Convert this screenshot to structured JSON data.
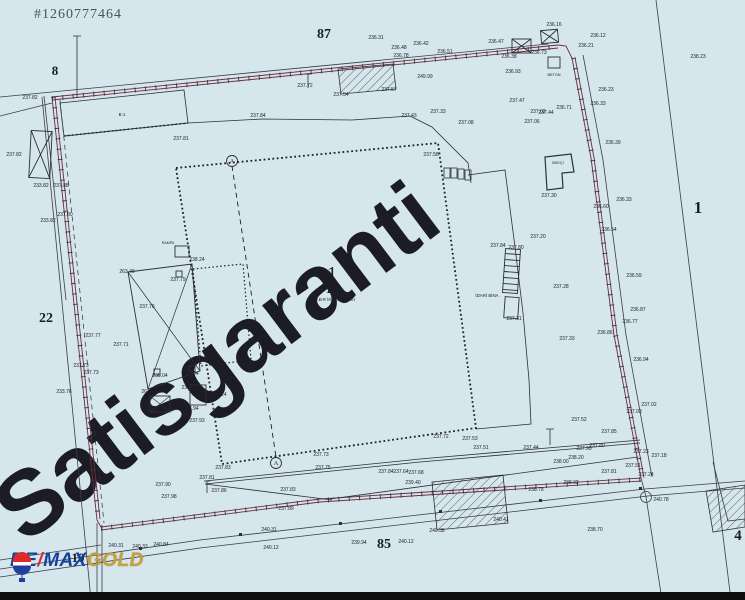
{
  "listing_id": "#1260777464",
  "watermark": "Satisgaranti",
  "colors": {
    "background": "#d5e6ec",
    "ink": "#2e2e36",
    "fence": "#6b2b3d",
    "watermark": "rgba(255,255,255,0.5)",
    "bottom_bar": "#0e0e0e"
  },
  "logo": {
    "brand_left": "RE",
    "brand_slash": "/",
    "brand_right": "MAX",
    "suffix": "GOLD",
    "brand_color": "#15439c",
    "slash_color": "#e02a2a",
    "suffix_color": "#c79f3c",
    "balloon_top": "#e02a2a",
    "balloon_bottom": "#1e3f9e"
  },
  "building": {
    "no": "1",
    "area": "141",
    "name": "FABRİKA BİNASI",
    "admin": "İDARİ BİNA",
    "guard": "BEKÇİ",
    "concrete": "BETON",
    "ramp": "RAMPA",
    "wing": "B.1"
  },
  "parcel_labels": [
    {
      "t": "8",
      "x": 55,
      "y": 75,
      "s": 13
    },
    {
      "t": "87",
      "x": 324,
      "y": 38,
      "s": 14
    },
    {
      "t": "22",
      "x": 46,
      "y": 322,
      "s": 14
    },
    {
      "t": "1",
      "x": 698,
      "y": 213,
      "s": 17
    },
    {
      "t": "85",
      "x": 384,
      "y": 548,
      "s": 14
    },
    {
      "t": "10",
      "x": 78,
      "y": 562,
      "s": 13
    },
    {
      "t": "4",
      "x": 738,
      "y": 540,
      "s": 15
    }
  ],
  "point_markers": [
    {
      "t": "A",
      "x": 232,
      "y": 161
    },
    {
      "t": "A",
      "x": 276,
      "y": 463
    }
  ],
  "elevations": [
    [
      30,
      99,
      "237.82"
    ],
    [
      258,
      117,
      "237.84"
    ],
    [
      181,
      140,
      "237.81"
    ],
    [
      41,
      187,
      "233.82"
    ],
    [
      61,
      187,
      "237.88"
    ],
    [
      48,
      222,
      "233.82"
    ],
    [
      65,
      216,
      "237.80"
    ],
    [
      14,
      156,
      "237.82"
    ],
    [
      305,
      87,
      "237.72"
    ],
    [
      341,
      96,
      "237.54"
    ],
    [
      389,
      91,
      "237.57"
    ],
    [
      376,
      39,
      "236.31"
    ],
    [
      399,
      49,
      "236.48"
    ],
    [
      401,
      57,
      "236.78"
    ],
    [
      421,
      45,
      "236.42"
    ],
    [
      445,
      53,
      "236.51"
    ],
    [
      496,
      43,
      "236.47"
    ],
    [
      509,
      58,
      "236.38"
    ],
    [
      539,
      54,
      "236.73"
    ],
    [
      554,
      26,
      "236.16"
    ],
    [
      598,
      37,
      "236.12"
    ],
    [
      586,
      47,
      "236.21"
    ],
    [
      513,
      73,
      "236.93"
    ],
    [
      425,
      78,
      "249.99"
    ],
    [
      606,
      91,
      "236.23"
    ],
    [
      598,
      105,
      "236.33"
    ],
    [
      564,
      109,
      "236.71"
    ],
    [
      538,
      113,
      "237.02"
    ],
    [
      438,
      113,
      "237.33"
    ],
    [
      409,
      117,
      "237.43"
    ],
    [
      431,
      156,
      "237.58"
    ],
    [
      466,
      124,
      "237.08"
    ],
    [
      517,
      102,
      "237.47"
    ],
    [
      532,
      123,
      "237.06"
    ],
    [
      546,
      114,
      "237.44"
    ],
    [
      613,
      144,
      "236.39"
    ],
    [
      624,
      201,
      "236.33"
    ],
    [
      609,
      231,
      "236.54"
    ],
    [
      601,
      208,
      "236.60"
    ],
    [
      634,
      277,
      "236.59"
    ],
    [
      638,
      311,
      "236.87"
    ],
    [
      630,
      323,
      "236.77"
    ],
    [
      605,
      334,
      "236.86"
    ],
    [
      641,
      361,
      "236.94"
    ],
    [
      567,
      340,
      "237.33"
    ],
    [
      561,
      288,
      "237.28"
    ],
    [
      649,
      406,
      "237.02"
    ],
    [
      634,
      413,
      "237.03"
    ],
    [
      579,
      421,
      "237.52"
    ],
    [
      609,
      433,
      "237.85"
    ],
    [
      641,
      453,
      "237.23"
    ],
    [
      659,
      457,
      "237.18"
    ],
    [
      633,
      467,
      "237.51"
    ],
    [
      646,
      476,
      "237.24"
    ],
    [
      609,
      473,
      "237.81"
    ],
    [
      549,
      197,
      "237.30"
    ],
    [
      538,
      238,
      "237.20"
    ],
    [
      498,
      247,
      "237.84"
    ],
    [
      516,
      249,
      "237.80"
    ],
    [
      514,
      320,
      "237.31"
    ],
    [
      93,
      337,
      "237.77"
    ],
    [
      81,
      367,
      "237.73"
    ],
    [
      91,
      374,
      "237.73"
    ],
    [
      64,
      393,
      "233.76"
    ],
    [
      127,
      273,
      "263.49"
    ],
    [
      149,
      393,
      "263.27"
    ],
    [
      160,
      377,
      "238.04"
    ],
    [
      191,
      375,
      "238.04"
    ],
    [
      189,
      389,
      "238.11"
    ],
    [
      219,
      396,
      "238.24"
    ],
    [
      197,
      261,
      "238.24"
    ],
    [
      178,
      281,
      "237.79"
    ],
    [
      121,
      346,
      "237.71"
    ],
    [
      147,
      308,
      "237.76"
    ],
    [
      191,
      410,
      "237.94"
    ],
    [
      197,
      422,
      "237.93"
    ],
    [
      163,
      486,
      "237.90"
    ],
    [
      169,
      498,
      "237.98"
    ],
    [
      223,
      469,
      "237.83"
    ],
    [
      207,
      479,
      "237.81"
    ],
    [
      219,
      492,
      "237.86"
    ],
    [
      321,
      456,
      "237.73"
    ],
    [
      323,
      469,
      "237.75"
    ],
    [
      288,
      491,
      "237.83"
    ],
    [
      286,
      510,
      "237.89"
    ],
    [
      116,
      547,
      "240.31"
    ],
    [
      140,
      548,
      "240.33"
    ],
    [
      161,
      546,
      "240.84"
    ],
    [
      271,
      549,
      "240.12"
    ],
    [
      359,
      544,
      "239.94"
    ],
    [
      406,
      543,
      "240.12"
    ],
    [
      269,
      531,
      "240.31"
    ],
    [
      437,
      532,
      "240.38"
    ],
    [
      501,
      521,
      "240.41"
    ],
    [
      413,
      484,
      "239.40"
    ],
    [
      561,
      463,
      "238.00"
    ],
    [
      536,
      491,
      "238.78"
    ],
    [
      571,
      484,
      "238.92"
    ],
    [
      386,
      473,
      "237.84"
    ],
    [
      401,
      473,
      "237.64"
    ],
    [
      416,
      474,
      "237.68"
    ],
    [
      481,
      449,
      "237.51"
    ],
    [
      470,
      440,
      "237.53"
    ],
    [
      531,
      449,
      "237.44"
    ],
    [
      576,
      459,
      "238.20"
    ],
    [
      584,
      450,
      "237.90"
    ],
    [
      597,
      447,
      "237.80"
    ],
    [
      441,
      438,
      "237.72"
    ],
    [
      661,
      501,
      "240.78"
    ],
    [
      595,
      531,
      "238.70"
    ],
    [
      698,
      58,
      "238.23"
    ]
  ]
}
